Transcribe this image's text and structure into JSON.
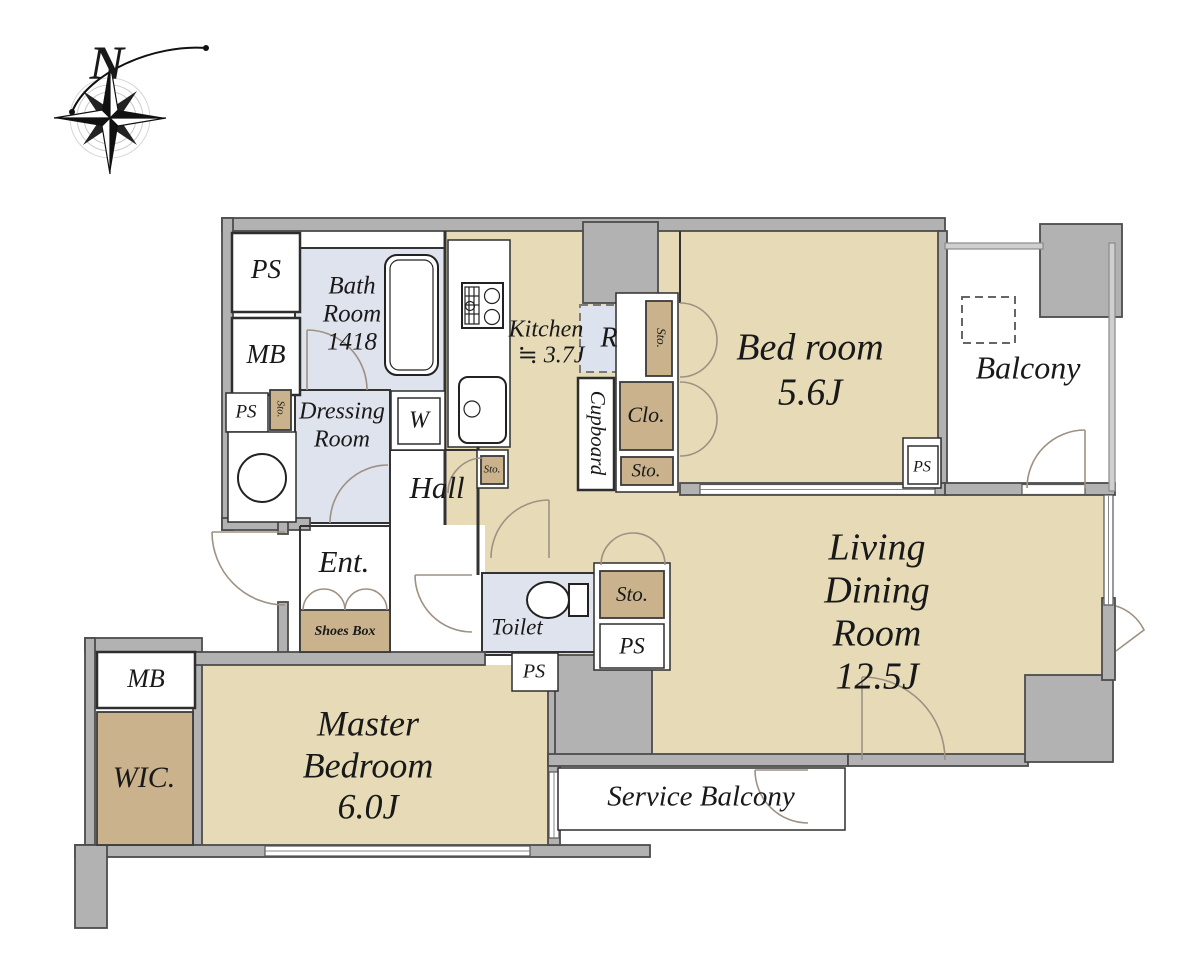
{
  "meta": {
    "type": "apartment-floor-plan"
  },
  "colors": {
    "room_fill": "#e7dbb7",
    "storage_fill": "#c9b28c",
    "wet_area_fill": "#dfe3ee",
    "wall_fill": "#b2b2b2",
    "outline": "#333333"
  },
  "compass": {
    "label": "N"
  },
  "rooms": {
    "bath": {
      "l1": "Bath",
      "l2": "Room",
      "l3": "1418"
    },
    "dressing": {
      "l1": "Dressing",
      "l2": "Room"
    },
    "kitchen": {
      "l1": "Kitchen",
      "l2": "≒ 3.7J"
    },
    "bedroom": {
      "name": "Bed room",
      "size": "5.6J"
    },
    "balcony": {
      "name": "Balcony"
    },
    "living": {
      "l1": "Living",
      "l2": "Dining",
      "l3": "Room",
      "size": "12.5J"
    },
    "master": {
      "l1": "Master",
      "l2": "Bedroom",
      "size": "6.0J"
    },
    "hall": {
      "name": "Hall"
    },
    "entrance": {
      "name": "Ent.",
      "shoes_box": "Shoes Box"
    },
    "toilet": {
      "name": "Toilet"
    },
    "service_balcony": {
      "name": "Service Balcony"
    },
    "wic": {
      "name": "WIC."
    }
  },
  "labels": {
    "ps_top": "PS",
    "mb_top": "MB",
    "ps_left": "PS",
    "sto_left": "Sto.",
    "w": "W",
    "r": "R",
    "sto_column": "Sto.",
    "clo": "Clo.",
    "sto_mid": "Sto.",
    "cupboard": "Cupboard",
    "sto_counter": "Sto.",
    "ps_bedroom": "PS",
    "sto_ld": "Sto.",
    "ps_ld": "PS",
    "ps_toilet": "PS",
    "mb_bottom": "MB"
  }
}
